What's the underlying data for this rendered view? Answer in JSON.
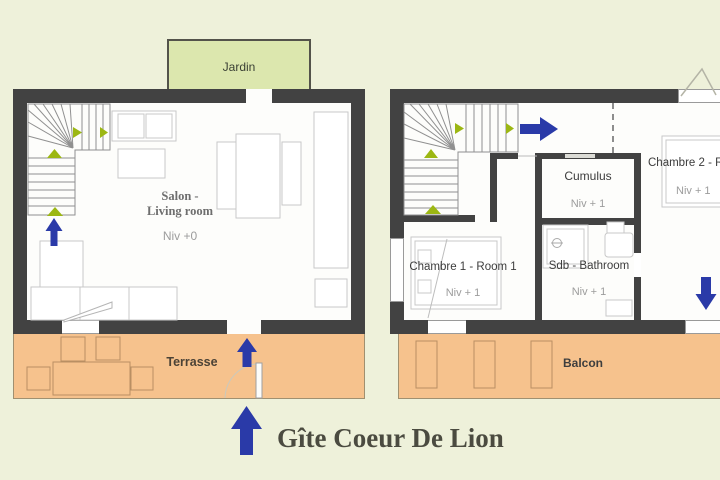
{
  "title": "Gîte Coeur De Lion",
  "ground_floor": {
    "garden": "Jardin",
    "living_room_fr": "Salon -",
    "living_room_en": "Living room",
    "living_room_level": "Niv +0",
    "terrace": "Terrasse"
  },
  "upper_floor": {
    "bedroom1": "Chambre 1 - Room 1",
    "bedroom1_level": "Niv + 1",
    "bedroom2": "Chambre 2 - R",
    "bedroom2_level": "Niv + 1",
    "bathroom": "Sdb - Bathroom",
    "bathroom_level": "Niv + 1",
    "water_heater": "Cumulus",
    "water_heater_level": "Niv + 1",
    "balcony": "Balcon"
  },
  "colors": {
    "background": "#eef1da",
    "wall": "#424242",
    "terrace_fill": "#f6c28d",
    "garden_fill": "#dce7ae",
    "arrow_blue": "#2a3aa8",
    "stair_marker_green": "#9cb713",
    "furniture_outline": "#c8c8c8"
  }
}
